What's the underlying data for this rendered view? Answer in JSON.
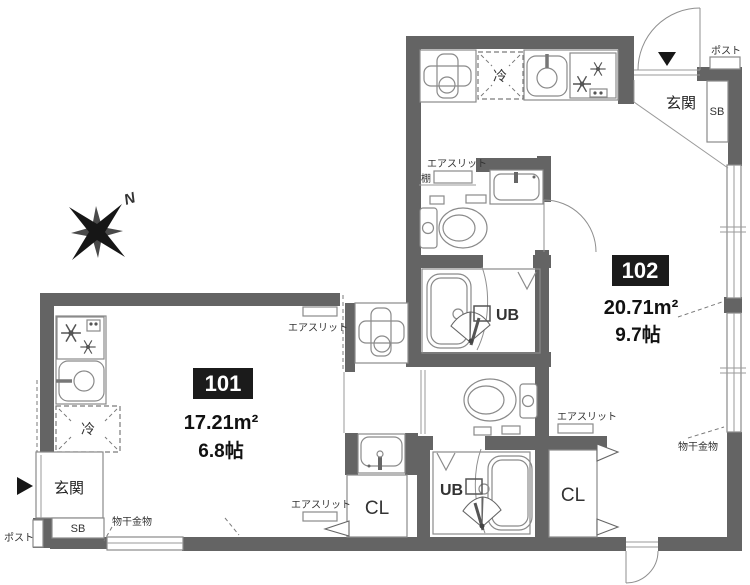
{
  "compass": {
    "north": "N"
  },
  "units": {
    "u101": {
      "number": "101",
      "area": "17.21m²",
      "tatami": "6.8帖",
      "entrance": "玄関",
      "shoe_box": "SB",
      "post": "ポスト",
      "fridge": "冷",
      "unit_bath": "UB",
      "closet": "CL",
      "air_slit_top": "エアスリット",
      "air_slit_bottom": "エアスリット",
      "laundry_bracket": "物干金物"
    },
    "u102": {
      "number": "102",
      "area": "20.71m²",
      "tatami": "9.7帖",
      "entrance": "玄関",
      "shoe_box": "SB",
      "post": "ポスト",
      "fridge": "冷",
      "unit_bath": "UB",
      "closet": "CL",
      "shelf": "棚",
      "air_slit_hall": "エアスリット",
      "air_slit_bottom": "エアスリット",
      "laundry_bracket": "物干金物"
    }
  },
  "colors": {
    "wall": "#646464",
    "line": "#8a8a8a",
    "badge_bg": "#1b1b1b",
    "badge_text": "#ffffff"
  }
}
